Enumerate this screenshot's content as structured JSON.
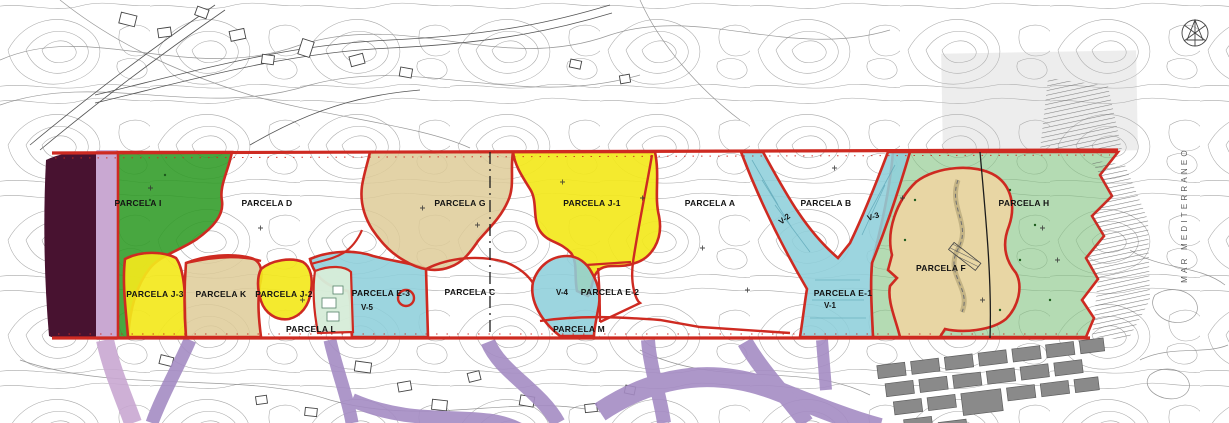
{
  "map": {
    "type": "urban-parcel-plan-over-topographic-base",
    "labels": [
      {
        "id": "parcela-i",
        "text": "PARCELA I"
      },
      {
        "id": "parcela-d",
        "text": "PARCELA D"
      },
      {
        "id": "parcela-g",
        "text": "PARCELA G"
      },
      {
        "id": "parcela-j1",
        "text": "PARCELA J-1"
      },
      {
        "id": "parcela-a",
        "text": "PARCELA A"
      },
      {
        "id": "parcela-b",
        "text": "PARCELA B"
      },
      {
        "id": "parcela-h",
        "text": "PARCELA H"
      },
      {
        "id": "parcela-j3",
        "text": "PARCELA J-3"
      },
      {
        "id": "parcela-k",
        "text": "PARCELA K"
      },
      {
        "id": "parcela-j2",
        "text": "PARCELA J-2"
      },
      {
        "id": "parcela-l",
        "text": "PARCELA L"
      },
      {
        "id": "parcela-e3",
        "text": "PARCELA E-3"
      },
      {
        "id": "v-5",
        "text": "V-5"
      },
      {
        "id": "parcela-c",
        "text": "PARCELA C"
      },
      {
        "id": "v-4",
        "text": "V-4"
      },
      {
        "id": "parcela-e2",
        "text": "PARCELA E-2"
      },
      {
        "id": "parcela-m",
        "text": "PARCELA M"
      },
      {
        "id": "parcela-e1",
        "text": "PARCELA E-1"
      },
      {
        "id": "v-1",
        "text": "V-1"
      },
      {
        "id": "parcela-f",
        "text": "PARCELA F"
      },
      {
        "id": "v-2",
        "text": "V-2"
      },
      {
        "id": "v-3",
        "text": "V-3"
      },
      {
        "id": "sea",
        "text": "MAR MEDITERRANEO"
      }
    ],
    "colors": {
      "boundary_red": "#ce2a21",
      "yellow_parcel": "#f3e81c",
      "dark_green_parcel": "#2f9b25",
      "light_green_parcel": "#86c584",
      "mint_parcel": "#d6ecd9",
      "tan_parcel": "#decb98",
      "teal_channel": "#8ecfdb",
      "maroon_band": "#481230",
      "purple_road": "#a58cc4",
      "gray_blocks": "#8a8a8a",
      "contour_line": "#979797"
    }
  }
}
